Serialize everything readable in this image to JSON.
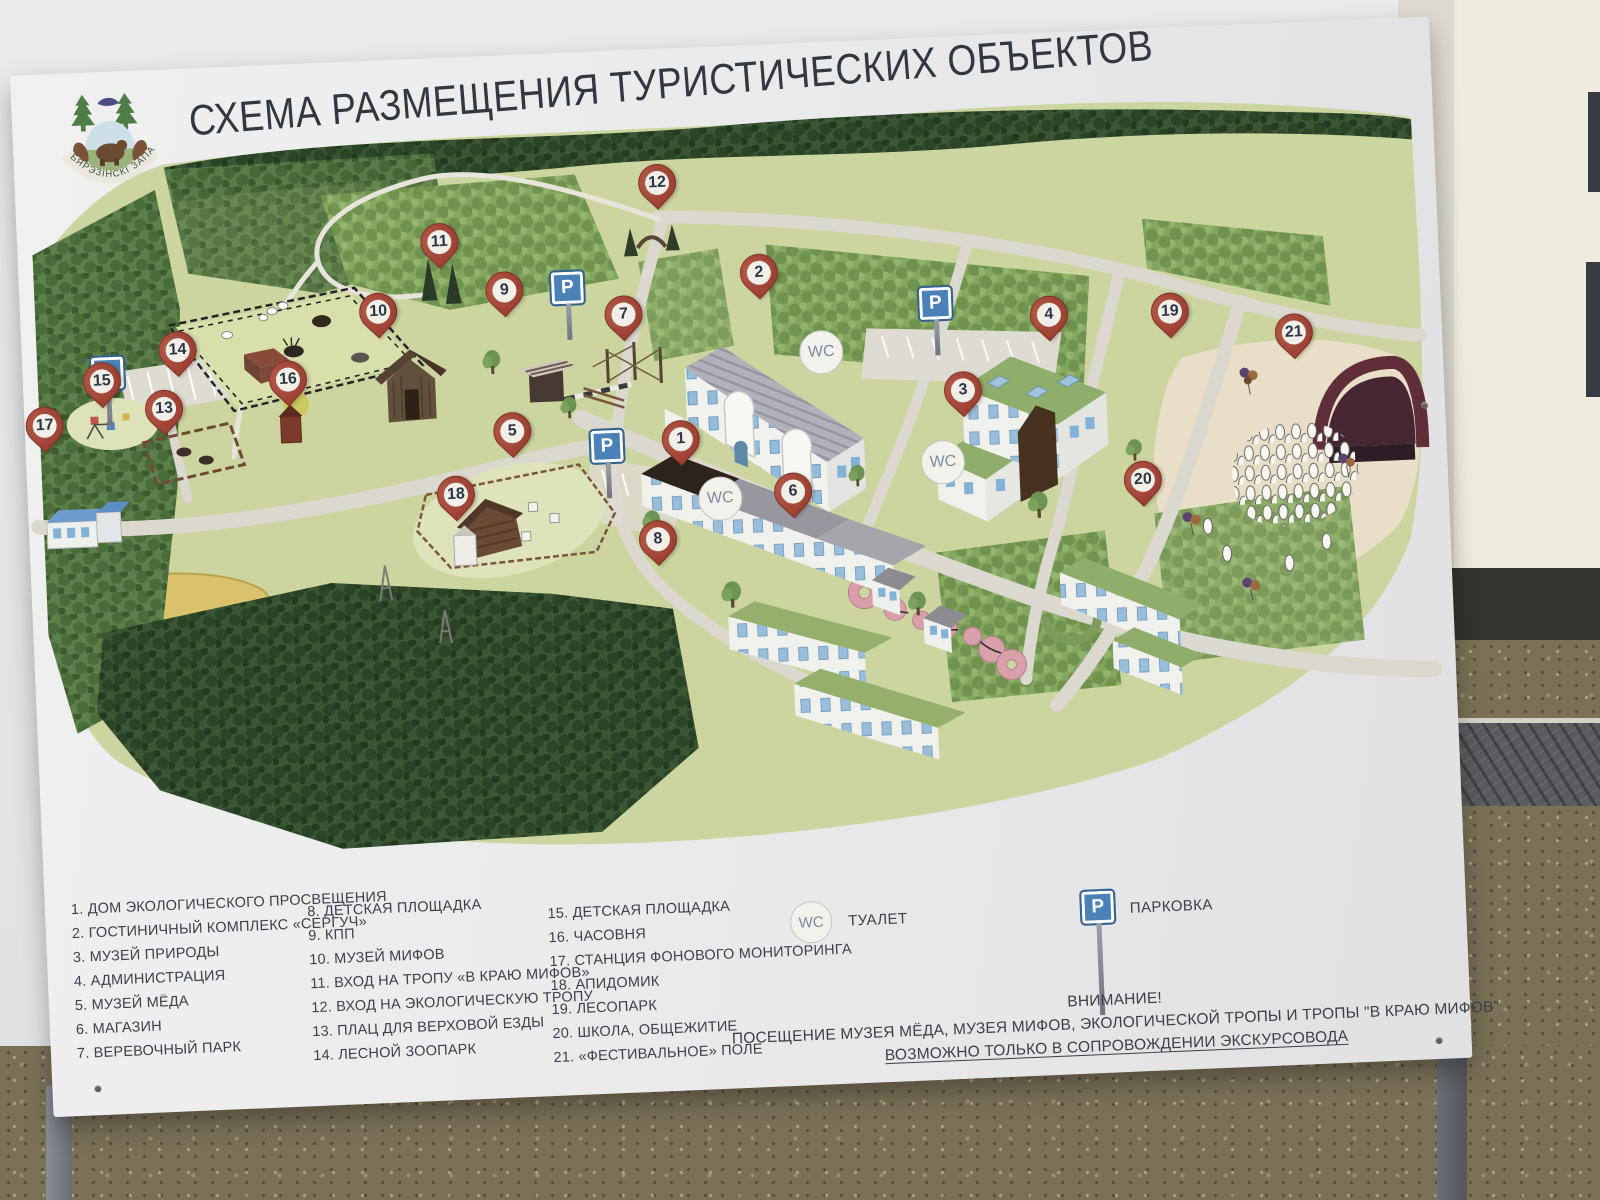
{
  "title": "СХЕМА РАЗМЕЩЕНИЯ ТУРИСТИЧЕСКИХ ОБЪЕКТОВ",
  "logo": {
    "caption": "БЯРЭЗІНСКІ ЗАПАВЕДНІК"
  },
  "map": {
    "symbols": {
      "wc": "WC",
      "parking": "P"
    },
    "markers": {
      "m1": "1",
      "m2": "2",
      "m3": "3",
      "m4": "4",
      "m5": "5",
      "m6": "6",
      "m7": "7",
      "m8": "8",
      "m9": "9",
      "m10": "10",
      "m11": "11",
      "m12": "12",
      "m13": "13",
      "m14": "14",
      "m15": "15",
      "m16": "16",
      "m17": "17",
      "m18": "18",
      "m19": "19",
      "m20": "20",
      "m21": "21"
    }
  },
  "legend": {
    "col1": [
      "1. ДОМ ЭКОЛОГИЧЕСКОГО ПРОСВЕЩЕНИЯ",
      "2. ГОСТИНИЧНЫЙ КОМПЛЕКС «СЕРГУЧ»",
      "3. МУЗЕЙ ПРИРОДЫ",
      "4. АДМИНИСТРАЦИЯ",
      "5. МУЗЕЙ МЁДА",
      "6. МАГАЗИН",
      "7. ВЕРЕВОЧНЫЙ ПАРК"
    ],
    "col2": [
      "8. ДЕТСКАЯ ПЛОЩАДКА",
      "9. КПП",
      "10. МУЗЕЙ МИФОВ",
      "11. ВХОД НА ТРОПУ «В КРАЮ МИФОВ»",
      "12. ВХОД НА ЭКОЛОГИЧЕСКУЮ ТРОПУ",
      "13. ПЛАЦ ДЛЯ ВЕРХОВОЙ ЕЗДЫ",
      "14. ЛЕСНОЙ ЗООПАРК"
    ],
    "col3": [
      "15. ДЕТСКАЯ ПЛОЩАДКА",
      "16. ЧАСОВНЯ",
      "17. СТАНЦИЯ ФОНОВОГО МОНИТОРИНГА",
      "18. АПИДОМИК",
      "19. ЛЕСОПАРК",
      "20. ШКОЛА, ОБЩЕЖИТИЕ",
      "21. «ФЕСТИВАЛЬНОЕ» ПОЛЕ"
    ],
    "wc_symbol": "WC",
    "wc_label": "ТУАЛЕТ",
    "parking_symbol": "P",
    "parking_label": "ПАРКОВКА"
  },
  "notice": {
    "line1": "ВНИМАНИЕ!",
    "line2": "ПОСЕЩЕНИЕ МУЗЕЯ МЁДА, МУЗЕЯ МИФОВ,  ЭКОЛОГИЧЕСКОЙ ТРОПЫ И ТРОПЫ \"В КРАЮ МИФОВ\"",
    "line3": "ВОЗМОЖНО ТОЛЬКО В СОПРОВОЖДЕНИИ ЭКСКУРСОВОДА"
  },
  "colors": {
    "marker_red": "#9c4133",
    "parking_blue": "#4a82b8",
    "map_ground": "#ccd5a0",
    "roof_green": "#8fae6b"
  }
}
